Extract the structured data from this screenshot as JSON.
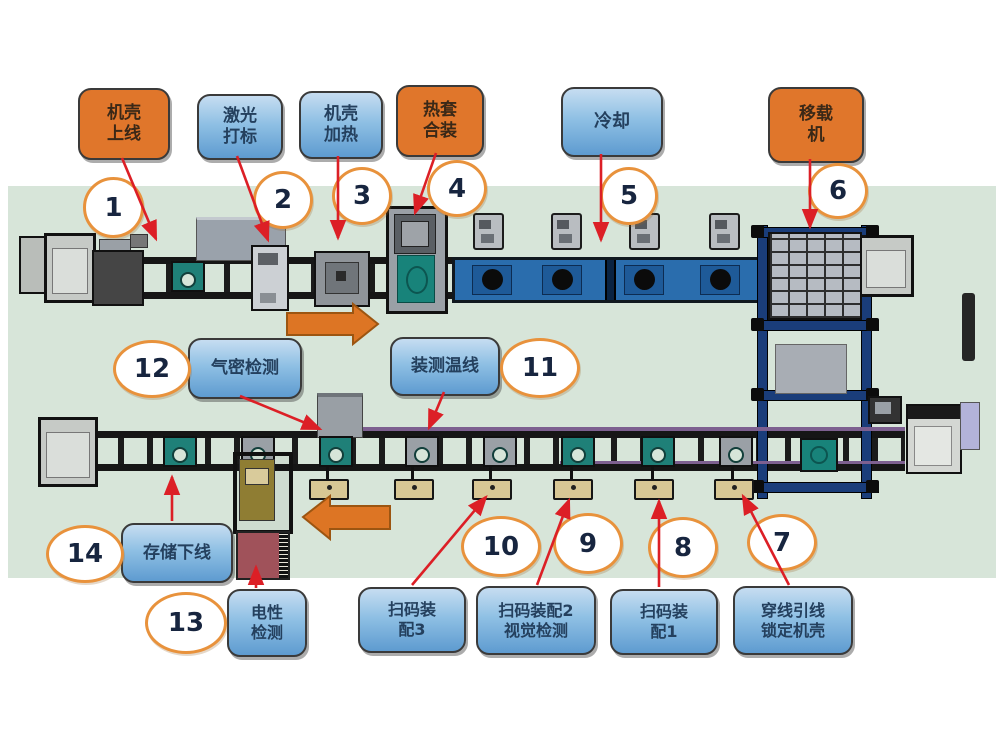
{
  "diagram": {
    "title": "工厂装配流水线工位示意图",
    "flow_arrows": [
      {
        "row": "top",
        "direction": "right"
      },
      {
        "row": "bottom",
        "direction": "left"
      }
    ],
    "colors": {
      "floor_band": "#d7e5d9",
      "orange_label": "#e0762b",
      "blue_label": "#5e9bd0",
      "number_circle_border": "#e8923c",
      "red_arrow": "#dc1f26",
      "flow_arrow": "#dd7524",
      "cooling_conveyor": "#2a6dad",
      "fixture_teal": "#1f8078"
    },
    "callouts": [
      {
        "num": "1",
        "label": "机壳\n上线",
        "style": "orange"
      },
      {
        "num": "2",
        "label": "激光\n打标",
        "style": "blue"
      },
      {
        "num": "3",
        "label": "机壳\n加热",
        "style": "blue"
      },
      {
        "num": "4",
        "label": "热套\n合装",
        "style": "orange"
      },
      {
        "num": "5",
        "label": "冷却",
        "style": "blue"
      },
      {
        "num": "6",
        "label": "移载\n机",
        "style": "orange"
      },
      {
        "num": "7",
        "label": "穿线引线\n锁定机壳",
        "style": "blue"
      },
      {
        "num": "8",
        "label": "扫码装\n配1",
        "style": "blue"
      },
      {
        "num": "9",
        "label": "扫码装配2\n视觉检测",
        "style": "blue"
      },
      {
        "num": "10",
        "label": "扫码装\n配3",
        "style": "blue"
      },
      {
        "num": "11",
        "label": "装测温线",
        "style": "blue"
      },
      {
        "num": "12",
        "label": "气密检测",
        "style": "blue"
      },
      {
        "num": "13",
        "label": "电性\n检测",
        "style": "blue"
      },
      {
        "num": "14",
        "label": "存储下线",
        "style": "blue"
      }
    ]
  }
}
